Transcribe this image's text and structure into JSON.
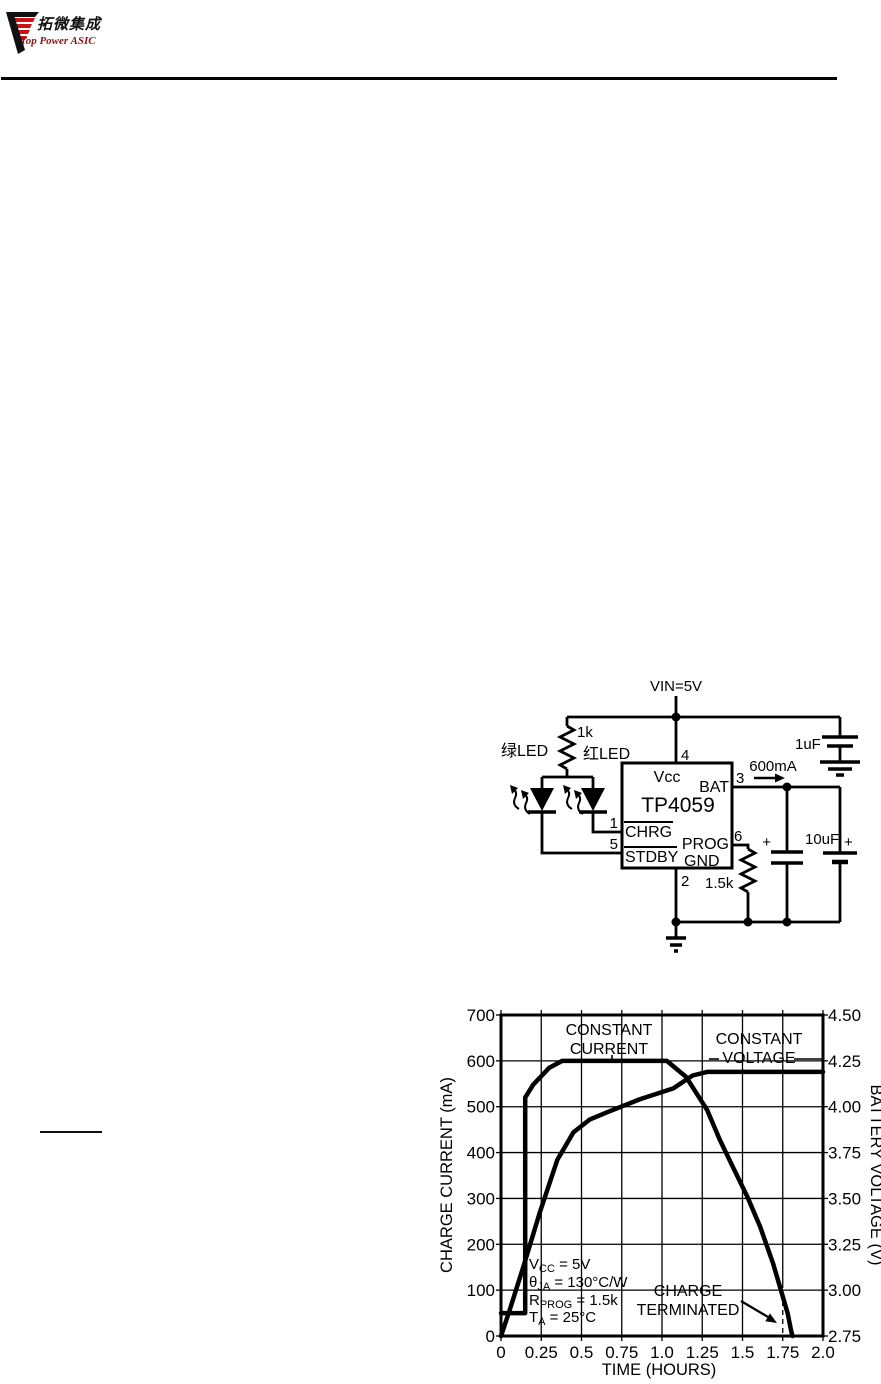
{
  "header": {
    "logo_chinese": "拓微集成",
    "logo_english": "Top Power ASIC",
    "logo_red": "#cc1111",
    "logo_black": "#111111"
  },
  "circuit": {
    "vin": "VIN=5V",
    "r_top": "1k",
    "led_green": "绿LED",
    "led_red": "红LED",
    "chip": "TP4059",
    "pin_vcc": "Vcc",
    "pin_vcc_num": "4",
    "pin_bat": "BAT",
    "pin_bat_num": "3",
    "pin_chrg": "CHRG",
    "pin_chrg_num": "1",
    "pin_prog": "PROG",
    "pin_prog_num": "6",
    "pin_stdby": "STDBY",
    "pin_stdby_num": "5",
    "pin_gnd": "GND",
    "pin_gnd_num": "2",
    "current": "600mA",
    "cap_in": "1uF",
    "cap_out": "10uF",
    "r_prog": "1.5k",
    "plus": "+"
  },
  "chart_data": {
    "type": "line",
    "xlabel": "TIME (HOURS)",
    "ylabel_left": "CHARGE CURRENT (mA)",
    "ylabel_right": "BATTERY VOLTAGE (V)",
    "xlim": [
      0,
      2.0
    ],
    "ylim_left": [
      0,
      700
    ],
    "ylim_right": [
      2.75,
      4.5
    ],
    "grid": true,
    "dashed_gridline_x": 1.75,
    "xticks": {
      "values": [
        0,
        0.25,
        0.5,
        0.75,
        1.0,
        1.25,
        1.5,
        1.75,
        2.0
      ],
      "labels": [
        "0",
        "0.25",
        "0.5",
        "0.75",
        "1.0",
        "1.25",
        "1.5",
        "1.75",
        "2.0"
      ]
    },
    "yticks_left": {
      "values": [
        0,
        100,
        200,
        300,
        400,
        500,
        600,
        700
      ],
      "labels": [
        "0",
        "100",
        "200",
        "300",
        "400",
        "500",
        "600",
        "700"
      ]
    },
    "yticks_right": {
      "values": [
        2.75,
        3.0,
        3.25,
        3.5,
        3.75,
        4.0,
        4.25,
        4.5
      ],
      "labels": [
        "2.75",
        "3.00",
        "3.25",
        "3.50",
        "3.75",
        "4.00",
        "4.25",
        "4.50"
      ]
    },
    "series": [
      {
        "name": "charge-current",
        "axis": "left",
        "points": [
          [
            0,
            50
          ],
          [
            0.15,
            50
          ],
          [
            0.15,
            520
          ],
          [
            0.2,
            548
          ],
          [
            0.3,
            585
          ],
          [
            0.38,
            600
          ],
          [
            1.03,
            600
          ],
          [
            1.15,
            565
          ],
          [
            1.28,
            493
          ],
          [
            1.36,
            427
          ],
          [
            1.44,
            369
          ],
          [
            1.53,
            304
          ],
          [
            1.61,
            238
          ],
          [
            1.69,
            158
          ],
          [
            1.75,
            86
          ],
          [
            1.78,
            50
          ],
          [
            1.8,
            15
          ],
          [
            1.81,
            0
          ]
        ]
      },
      {
        "name": "battery-voltage",
        "axis": "right",
        "points": [
          [
            0,
            2.75
          ],
          [
            0.05,
            2.88
          ],
          [
            0.14,
            3.13
          ],
          [
            0.24,
            3.42
          ],
          [
            0.35,
            3.71
          ],
          [
            0.45,
            3.86
          ],
          [
            0.55,
            3.93
          ],
          [
            0.66,
            3.97
          ],
          [
            0.86,
            4.04
          ],
          [
            1.07,
            4.1
          ],
          [
            1.19,
            4.17
          ],
          [
            1.28,
            4.19
          ],
          [
            2.0,
            4.19
          ]
        ]
      }
    ],
    "annotations": [
      {
        "id": "constant-current",
        "lines": [
          "CONSTANT",
          "CURRENT"
        ],
        "x": 172,
        "y": 30,
        "gap": 19
      },
      {
        "id": "constant-voltage",
        "lines": [
          "CONSTANT",
          "VOLTAGE"
        ],
        "x": 322,
        "y": 39,
        "gap": 19
      },
      {
        "id": "charge-terminated",
        "lines": [
          "CHARGE",
          "TERMINATED"
        ],
        "x": 251,
        "y": 291,
        "gap": 19
      }
    ],
    "conditions": [
      {
        "pre": "V",
        "sub": "CC",
        "post": " = 5V"
      },
      {
        "pre": "θ",
        "sub": "JA",
        "post": " = 130°C/W"
      },
      {
        "pre": "R",
        "sub": "PROG",
        "post": " = 1.5k"
      },
      {
        "pre": "T",
        "sub": "A",
        "post": " = 25°C"
      }
    ]
  }
}
